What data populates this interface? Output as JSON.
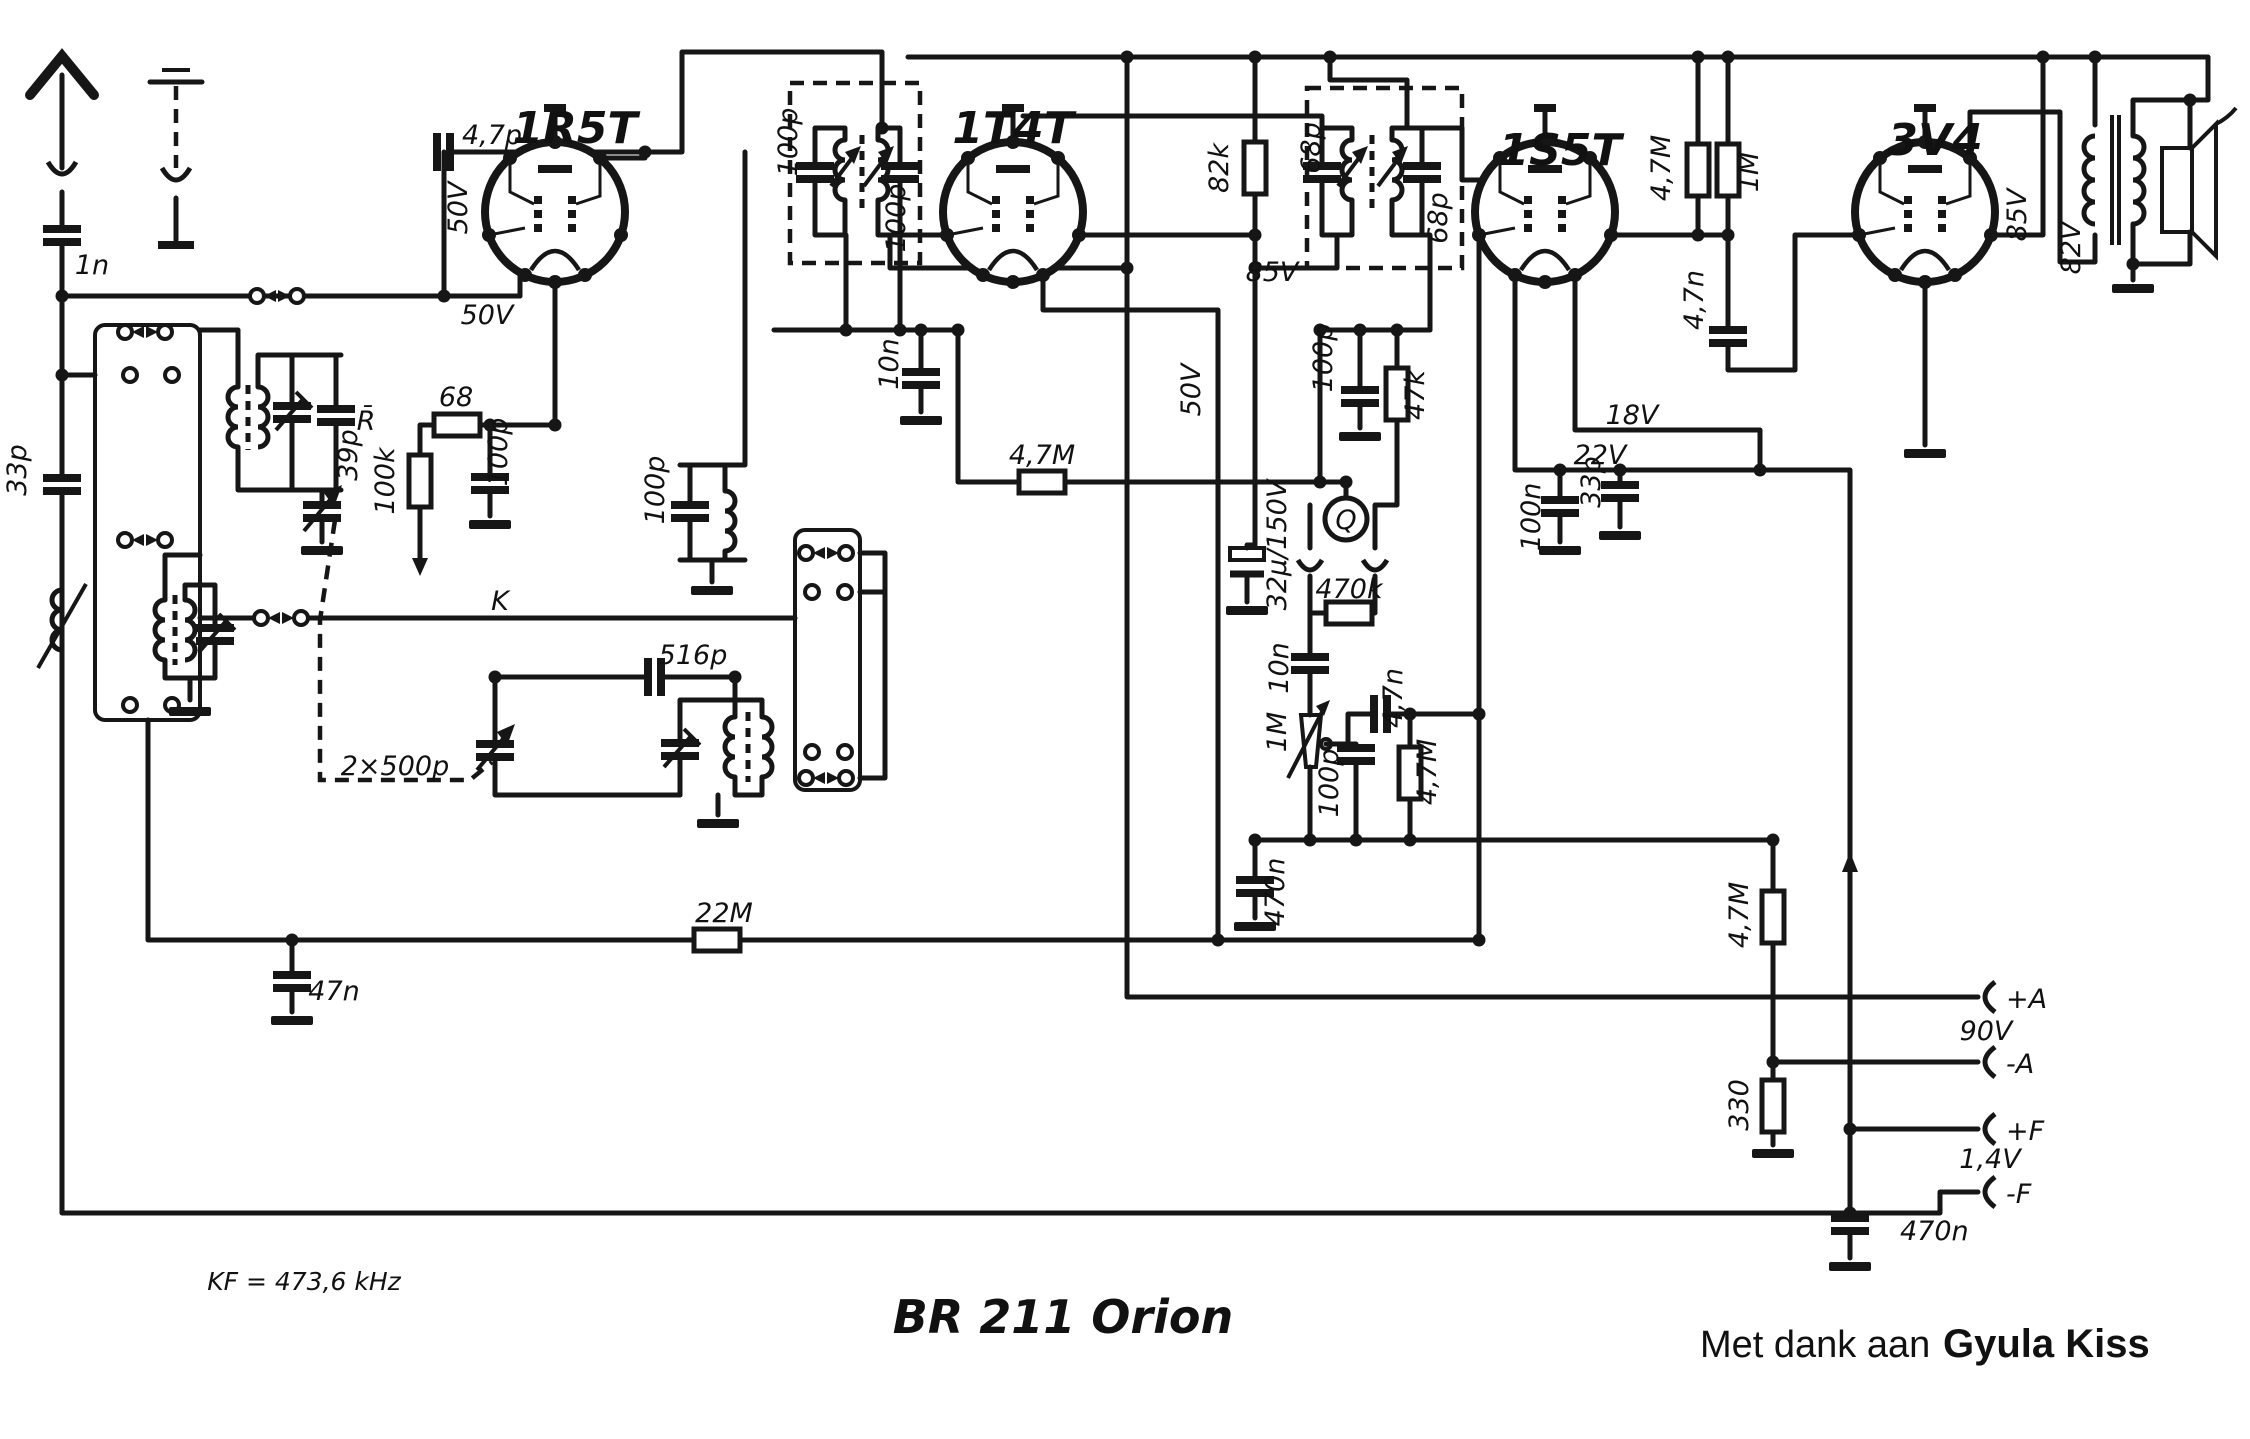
{
  "diagram_title": "BR 211 Orion",
  "credit": {
    "prefix": "Met dank aan ",
    "name": "Gyula Kiss"
  },
  "note_if": "KF = 473,6 kHz",
  "tubes": {
    "t1": "1R5T",
    "t2": "1T4T",
    "t3": "1S5T",
    "t4": "3V4"
  },
  "voltages": {
    "v50_a": "50V",
    "v50_b": "50V",
    "v50_c": "50V",
    "v85_a": "85V",
    "v85_b": "85V",
    "v82": "82V",
    "v18": "18V",
    "v22": "22V",
    "v90": "90V",
    "v14": "1,4V"
  },
  "capacitors": {
    "c47p": "4,7p",
    "c1n": "1n",
    "c33p_ant": "33p",
    "c39p": "39p",
    "c100p_t1": "100p",
    "c100p_osc": "100p",
    "c516p": "516p",
    "gang": "2×500p",
    "c47n_bias": "47n",
    "c100p_if1a": "100p",
    "c100p_if1b": "100p",
    "c10n_if": "10n",
    "c68p_a": "68p",
    "c68p_b": "68p",
    "c100p_det": "100p",
    "c32u": "32µ/150V",
    "c10n_det": "10n",
    "c47n_af": "4,7n",
    "c100p_af": "100p",
    "c470n_af": "470n",
    "c100n": "100n",
    "c33p_af": "33p",
    "c47n_out": "4,7n",
    "c470n_ps": "470n"
  },
  "resistors": {
    "r68": "68",
    "r100k": "100k",
    "r82k": "82k",
    "r47m_avc": "4,7M",
    "r47k": "47k",
    "r470k": "470k",
    "r1m_pot": "1M",
    "r47m_af": "4,7M",
    "r22m": "22M",
    "r47m_pl": "4,7M",
    "r1m_pl": "1M",
    "r47m_ps": "4,7M",
    "r330": "330"
  },
  "terminals": {
    "plus_a": "+A",
    "minus_a": "-A",
    "plus_f": "+F",
    "minus_f": "-F"
  },
  "symbols": {
    "r_bar": "R̄",
    "k": "K",
    "q": "Q"
  }
}
